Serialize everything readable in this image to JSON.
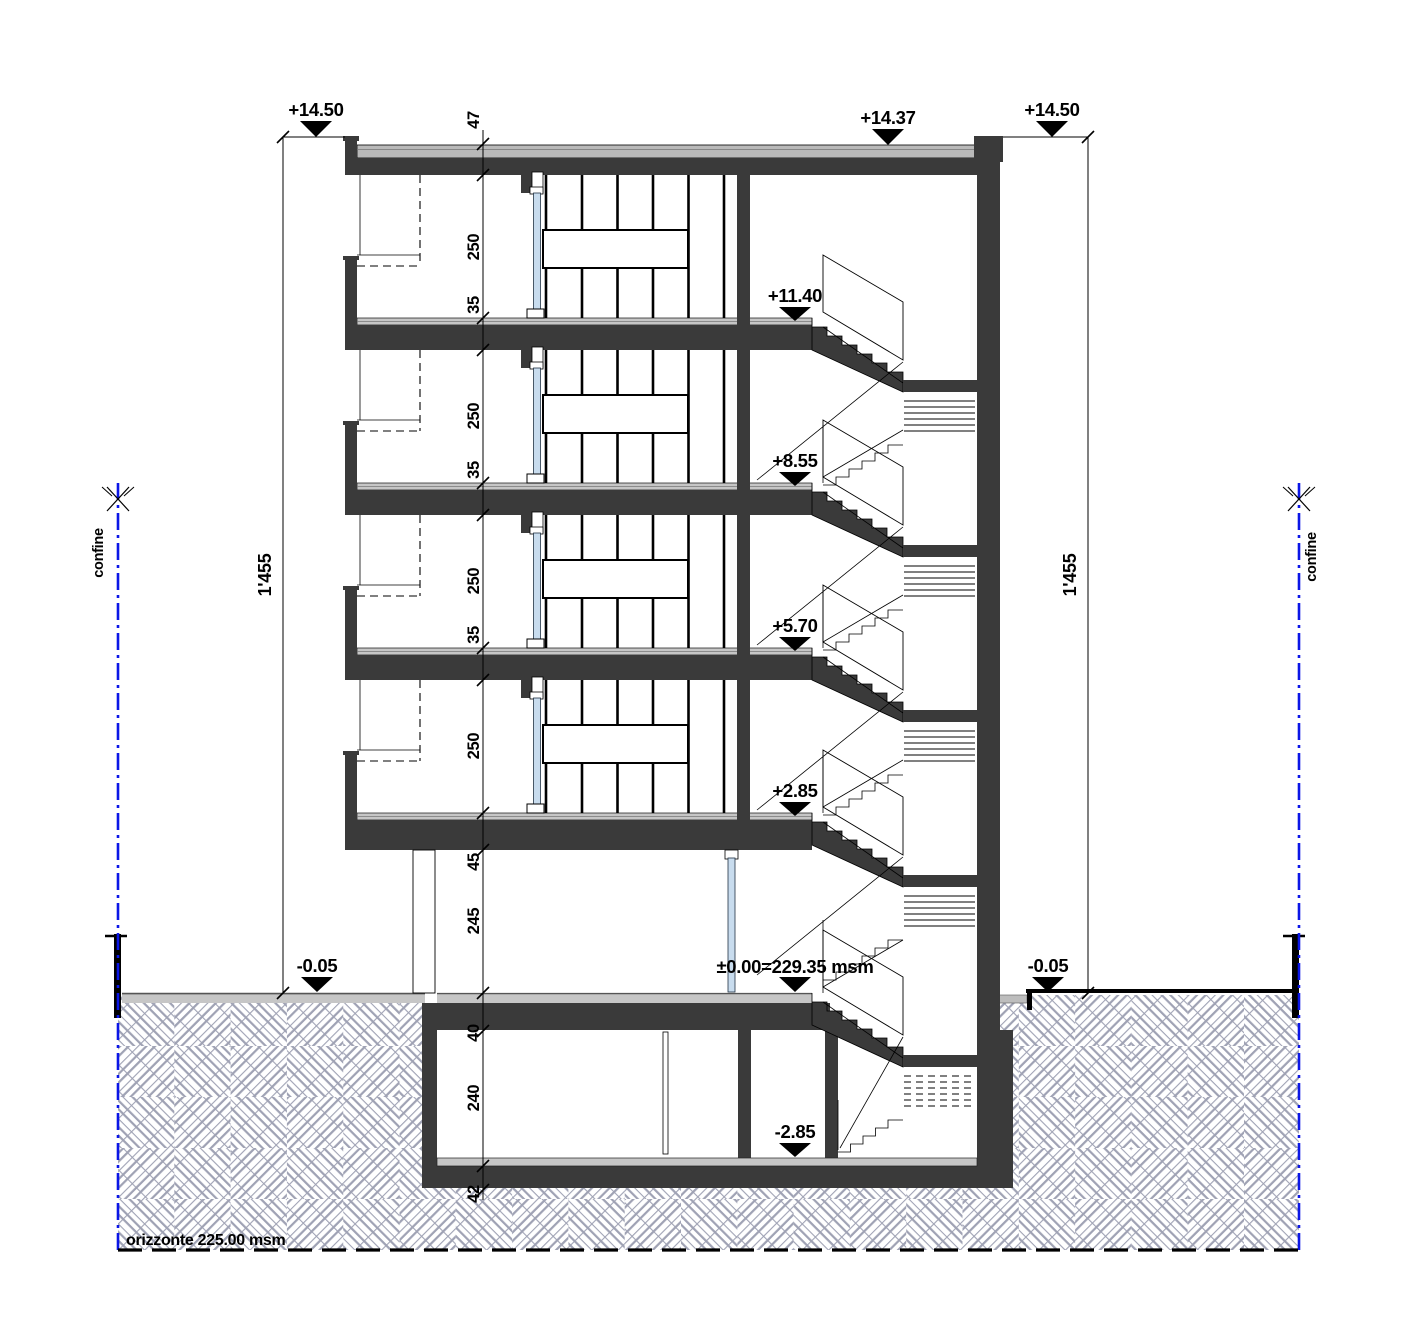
{
  "drawing": {
    "levels": {
      "roof_left": {
        "label": "+14.50"
      },
      "roof_right": {
        "label": "+14.50"
      },
      "roof_mid": {
        "label": "+14.37"
      },
      "floor3": {
        "label": "+11.40"
      },
      "floor2": {
        "label": "+8.55"
      },
      "floor1": {
        "label": "+5.70"
      },
      "floor0": {
        "label": "+2.85"
      },
      "ground_left": {
        "label": "-0.05"
      },
      "ground_right": {
        "label": "-0.05"
      },
      "entry": {
        "label": "±0.00=229.35 msm"
      },
      "basement": {
        "label": "-2.85"
      }
    },
    "dimension_chain": [
      "47",
      "250",
      "35",
      "250",
      "35",
      "250",
      "35",
      "250",
      "45",
      "245",
      "40",
      "240",
      "42"
    ],
    "total_height_left": "1'455",
    "total_height_right": "1'455",
    "boundary_left": "confine",
    "boundary_right": "confine",
    "datum_line": "orizzonte 225.00 msm",
    "colors": {
      "boundary": "#0b16e6",
      "entry_level": "#e00000",
      "wall": "#3a3a3a",
      "glass": "#c8dcee",
      "hatch": "#9fa2b4",
      "slab_finish": "#c6c6c6",
      "roof_finish": "#b9b9b9"
    }
  }
}
